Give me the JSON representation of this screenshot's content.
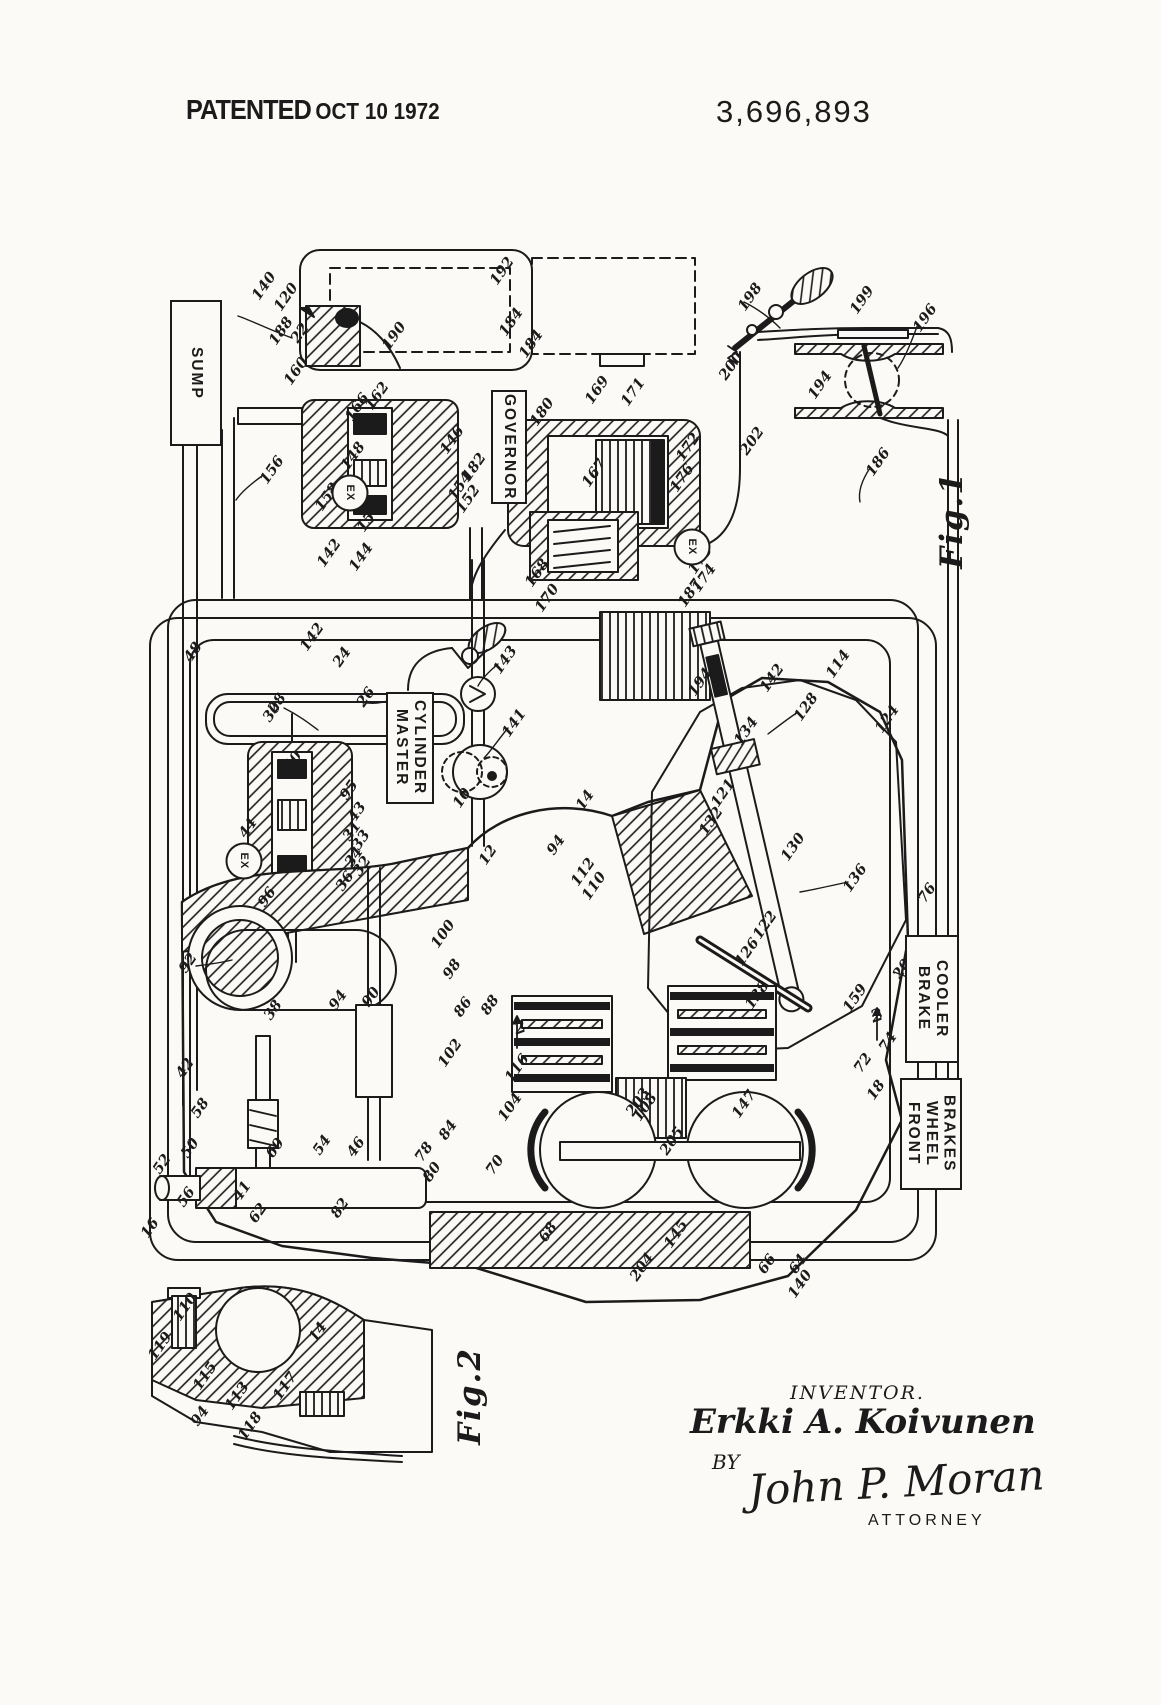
{
  "header": {
    "patented": "PATENTED",
    "date": "OCT 10 1972",
    "number": "3,696,893"
  },
  "figures": {
    "fig1": {
      "label": "Fig.1",
      "x": 952,
      "y": 520
    },
    "fig2": {
      "label": "Fig.2",
      "x": 470,
      "y": 1396
    }
  },
  "component_labels": [
    {
      "name": "sump",
      "text": "SUMP",
      "x": 170,
      "y": 300,
      "w": 52,
      "h": 146
    },
    {
      "name": "governor",
      "text": "GOVERNOR",
      "x": 491,
      "y": 390,
      "w": 36,
      "h": 114
    },
    {
      "name": "master-cylinder",
      "text": "MASTER\nCYLINDER",
      "x": 386,
      "y": 692,
      "w": 48,
      "h": 112
    },
    {
      "name": "brake-cooler",
      "text": "BRAKE\nCOOLER",
      "x": 905,
      "y": 935,
      "w": 54,
      "h": 128
    },
    {
      "name": "front-wheel-brakes",
      "text": "FRONT\nWHEEL\nBRAKES",
      "x": 900,
      "y": 1078,
      "w": 62,
      "h": 112
    }
  ],
  "ports": {
    "ex_label": "EX",
    "items": [
      {
        "x": 350,
        "y": 493
      },
      {
        "x": 692,
        "y": 547
      },
      {
        "x": 244,
        "y": 861
      }
    ]
  },
  "section_marks": [
    {
      "t": "2",
      "x": 877,
      "y": 1016
    },
    {
      "t": "2",
      "x": 520,
      "y": 1028
    }
  ],
  "ref_numerals": [
    {
      "t": "22",
      "x": 300,
      "y": 333
    },
    {
      "t": "140",
      "x": 264,
      "y": 286
    },
    {
      "t": "120",
      "x": 286,
      "y": 297
    },
    {
      "t": "188",
      "x": 281,
      "y": 331
    },
    {
      "t": "190",
      "x": 394,
      "y": 336
    },
    {
      "t": "160",
      "x": 296,
      "y": 371
    },
    {
      "t": "166",
      "x": 357,
      "y": 407
    },
    {
      "t": "162",
      "x": 377,
      "y": 396
    },
    {
      "t": "156",
      "x": 272,
      "y": 470
    },
    {
      "t": "158",
      "x": 327,
      "y": 497
    },
    {
      "t": "148",
      "x": 353,
      "y": 456
    },
    {
      "t": "146",
      "x": 452,
      "y": 440
    },
    {
      "t": "182",
      "x": 474,
      "y": 467
    },
    {
      "t": "154",
      "x": 460,
      "y": 486
    },
    {
      "t": "152",
      "x": 468,
      "y": 499
    },
    {
      "t": "150",
      "x": 369,
      "y": 518
    },
    {
      "t": "142",
      "x": 329,
      "y": 553
    },
    {
      "t": "144",
      "x": 361,
      "y": 557
    },
    {
      "t": "192",
      "x": 502,
      "y": 271
    },
    {
      "t": "184",
      "x": 511,
      "y": 322
    },
    {
      "t": "184",
      "x": 531,
      "y": 344
    },
    {
      "t": "180",
      "x": 542,
      "y": 412
    },
    {
      "t": "169",
      "x": 597,
      "y": 390
    },
    {
      "t": "171",
      "x": 633,
      "y": 392
    },
    {
      "t": "167",
      "x": 594,
      "y": 473
    },
    {
      "t": "172",
      "x": 688,
      "y": 447
    },
    {
      "t": "176",
      "x": 682,
      "y": 478
    },
    {
      "t": "178",
      "x": 700,
      "y": 560
    },
    {
      "t": "174",
      "x": 704,
      "y": 578
    },
    {
      "t": "187",
      "x": 690,
      "y": 593
    },
    {
      "t": "168",
      "x": 537,
      "y": 573
    },
    {
      "t": "170",
      "x": 547,
      "y": 598
    },
    {
      "t": "186",
      "x": 878,
      "y": 462
    },
    {
      "t": "198",
      "x": 750,
      "y": 297
    },
    {
      "t": "200",
      "x": 731,
      "y": 366
    },
    {
      "t": "202",
      "x": 752,
      "y": 441
    },
    {
      "t": "194",
      "x": 820,
      "y": 385
    },
    {
      "t": "199",
      "x": 862,
      "y": 300
    },
    {
      "t": "196",
      "x": 925,
      "y": 318
    },
    {
      "t": "142",
      "x": 312,
      "y": 637
    },
    {
      "t": "24",
      "x": 342,
      "y": 657
    },
    {
      "t": "26",
      "x": 366,
      "y": 697
    },
    {
      "t": "28",
      "x": 277,
      "y": 703
    },
    {
      "t": "143",
      "x": 505,
      "y": 660
    },
    {
      "t": "141",
      "x": 514,
      "y": 723
    },
    {
      "t": "48",
      "x": 193,
      "y": 652
    },
    {
      "t": "30",
      "x": 272,
      "y": 712
    },
    {
      "t": "40",
      "x": 293,
      "y": 761
    },
    {
      "t": "95",
      "x": 349,
      "y": 790
    },
    {
      "t": "43",
      "x": 357,
      "y": 812
    },
    {
      "t": "31",
      "x": 352,
      "y": 831
    },
    {
      "t": "33",
      "x": 361,
      "y": 840
    },
    {
      "t": "34",
      "x": 354,
      "y": 857
    },
    {
      "t": "32",
      "x": 362,
      "y": 866
    },
    {
      "t": "36",
      "x": 345,
      "y": 881
    },
    {
      "t": "44",
      "x": 248,
      "y": 828
    },
    {
      "t": "96",
      "x": 267,
      "y": 897
    },
    {
      "t": "92",
      "x": 188,
      "y": 963
    },
    {
      "t": "38",
      "x": 273,
      "y": 1010
    },
    {
      "t": "94",
      "x": 338,
      "y": 1000
    },
    {
      "t": "90",
      "x": 371,
      "y": 997
    },
    {
      "t": "100",
      "x": 443,
      "y": 934
    },
    {
      "t": "98",
      "x": 452,
      "y": 969
    },
    {
      "t": "10",
      "x": 462,
      "y": 798
    },
    {
      "t": "12",
      "x": 488,
      "y": 855
    },
    {
      "t": "14",
      "x": 585,
      "y": 800
    },
    {
      "t": "94",
      "x": 556,
      "y": 845
    },
    {
      "t": "112",
      "x": 583,
      "y": 872
    },
    {
      "t": "110",
      "x": 594,
      "y": 886
    },
    {
      "t": "102",
      "x": 450,
      "y": 1053
    },
    {
      "t": "116",
      "x": 517,
      "y": 1068
    },
    {
      "t": "104",
      "x": 510,
      "y": 1107
    },
    {
      "t": "108",
      "x": 645,
      "y": 1107
    },
    {
      "t": "88",
      "x": 490,
      "y": 1005
    },
    {
      "t": "86",
      "x": 463,
      "y": 1007
    },
    {
      "t": "84",
      "x": 448,
      "y": 1130
    },
    {
      "t": "70",
      "x": 495,
      "y": 1165
    },
    {
      "t": "78",
      "x": 424,
      "y": 1152
    },
    {
      "t": "80",
      "x": 432,
      "y": 1172
    },
    {
      "t": "82",
      "x": 340,
      "y": 1208
    },
    {
      "t": "42",
      "x": 185,
      "y": 1068
    },
    {
      "t": "58",
      "x": 200,
      "y": 1108
    },
    {
      "t": "50",
      "x": 190,
      "y": 1148
    },
    {
      "t": "60",
      "x": 275,
      "y": 1148
    },
    {
      "t": "54",
      "x": 322,
      "y": 1145
    },
    {
      "t": "46",
      "x": 356,
      "y": 1147
    },
    {
      "t": "52",
      "x": 162,
      "y": 1164
    },
    {
      "t": "56",
      "x": 186,
      "y": 1197
    },
    {
      "t": "16",
      "x": 150,
      "y": 1228
    },
    {
      "t": "41",
      "x": 242,
      "y": 1191
    },
    {
      "t": "62",
      "x": 258,
      "y": 1213
    },
    {
      "t": "66",
      "x": 767,
      "y": 1264
    },
    {
      "t": "64",
      "x": 798,
      "y": 1264
    },
    {
      "t": "68",
      "x": 548,
      "y": 1232
    },
    {
      "t": "205",
      "x": 672,
      "y": 1141
    },
    {
      "t": "203",
      "x": 638,
      "y": 1102
    },
    {
      "t": "147",
      "x": 744,
      "y": 1104
    },
    {
      "t": "145",
      "x": 676,
      "y": 1234
    },
    {
      "t": "204",
      "x": 642,
      "y": 1267
    },
    {
      "t": "140",
      "x": 800,
      "y": 1284
    },
    {
      "t": "142",
      "x": 772,
      "y": 678
    },
    {
      "t": "194",
      "x": 700,
      "y": 682
    },
    {
      "t": "128",
      "x": 806,
      "y": 707
    },
    {
      "t": "134",
      "x": 746,
      "y": 731
    },
    {
      "t": "124",
      "x": 887,
      "y": 719
    },
    {
      "t": "114",
      "x": 838,
      "y": 664
    },
    {
      "t": "121",
      "x": 723,
      "y": 793
    },
    {
      "t": "132",
      "x": 711,
      "y": 821
    },
    {
      "t": "130",
      "x": 793,
      "y": 847
    },
    {
      "t": "136",
      "x": 855,
      "y": 878
    },
    {
      "t": "76",
      "x": 927,
      "y": 893
    },
    {
      "t": "122",
      "x": 765,
      "y": 925
    },
    {
      "t": "126",
      "x": 747,
      "y": 952
    },
    {
      "t": "138",
      "x": 757,
      "y": 995
    },
    {
      "t": "20",
      "x": 902,
      "y": 969
    },
    {
      "t": "159",
      "x": 855,
      "y": 998
    },
    {
      "t": "74",
      "x": 888,
      "y": 1042
    },
    {
      "t": "72",
      "x": 863,
      "y": 1063
    },
    {
      "t": "18",
      "x": 876,
      "y": 1090
    },
    {
      "t": "110",
      "x": 185,
      "y": 1307
    },
    {
      "t": "14",
      "x": 318,
      "y": 1332
    },
    {
      "t": "119",
      "x": 160,
      "y": 1346
    },
    {
      "t": "115",
      "x": 205,
      "y": 1376
    },
    {
      "t": "117",
      "x": 285,
      "y": 1386
    },
    {
      "t": "113",
      "x": 237,
      "y": 1396
    },
    {
      "t": "94",
      "x": 200,
      "y": 1416
    },
    {
      "t": "118",
      "x": 250,
      "y": 1426
    }
  ],
  "signature": {
    "heading": "INVENTOR.",
    "name": "Erkki A. Koivunen",
    "by": "BY",
    "attorney": "John P. Moran",
    "title": "ATTORNEY"
  }
}
